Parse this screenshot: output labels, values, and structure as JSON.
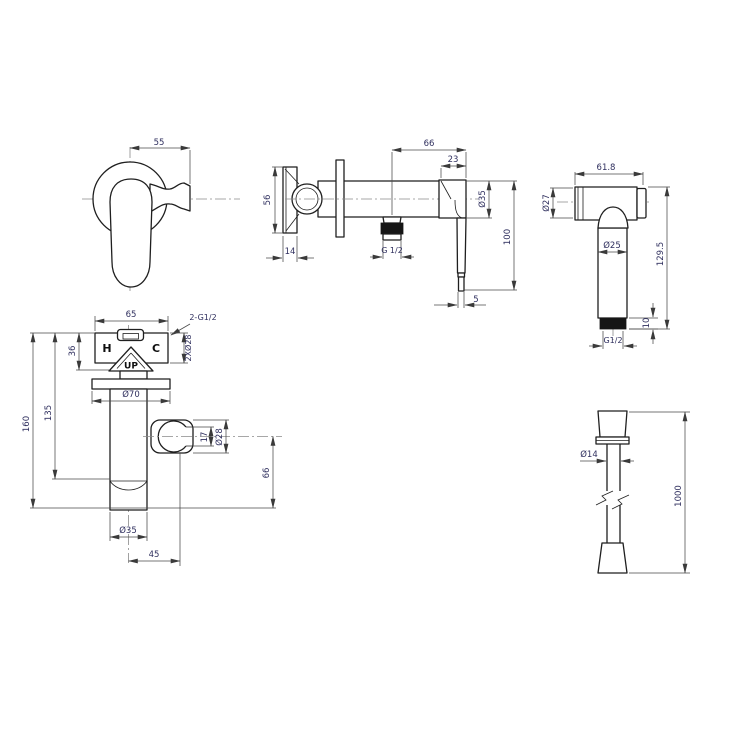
{
  "colors": {
    "background": "#ffffff",
    "object_line": "#1f1f1f",
    "dimension_line": "#4a4a4a",
    "dimension_text": "#2f2f5e",
    "label_text": "#0f0f0f",
    "thread_fill": "#161616"
  },
  "views": {
    "handle_front": {
      "width": "55"
    },
    "valve_side": {
      "depth": "66",
      "handle_width": "23",
      "plate_height": "56",
      "plate_thickness": "14",
      "outlet_thread": "G 1/2",
      "handle_diameter": "Ø35",
      "handle_length": "100",
      "lever_tip": "5"
    },
    "sprayer": {
      "head_width": "61.8",
      "head_diameter": "Ø27",
      "grip_diameter": "Ø25",
      "total_length": "129.5",
      "thread_length": "10",
      "thread": "G1/2"
    },
    "valve_front": {
      "body_width": "65",
      "inlet_thread": "2-G1/2",
      "hot": "H",
      "cold": "C",
      "up": "UP",
      "body_height": "36",
      "inlet_holes": "2XØ28",
      "flange_diameter": "Ø70",
      "spout_height": "135",
      "total_height": "160",
      "holder_opening": "17",
      "holder_diameter": "Ø28",
      "holder_drop": "66",
      "spout_diameter": "Ø35",
      "holder_offset": "45"
    },
    "hose": {
      "diameter": "Ø14",
      "length": "1000"
    }
  }
}
